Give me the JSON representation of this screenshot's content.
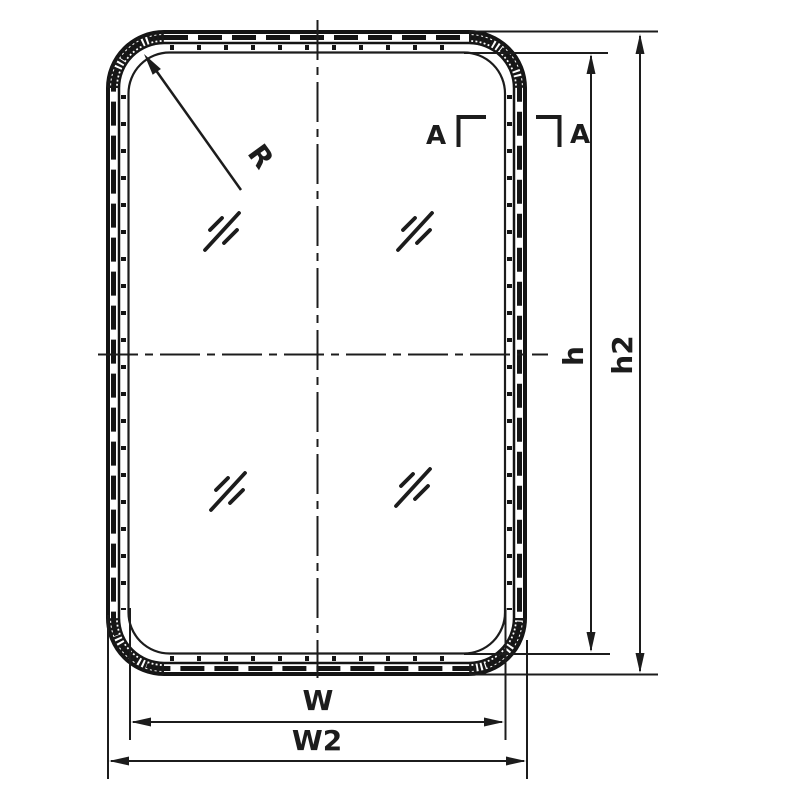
{
  "diagram": {
    "type": "technical-drawing-window-frame",
    "colors": {
      "line": "#1c1c1c",
      "background": "#ffffff"
    },
    "labels": {
      "radius": "R",
      "section_left": "A",
      "section_right": "A",
      "height_inner": "h",
      "height_overall": "h2",
      "width_inner": "W",
      "width_overall": "W2"
    }
  }
}
